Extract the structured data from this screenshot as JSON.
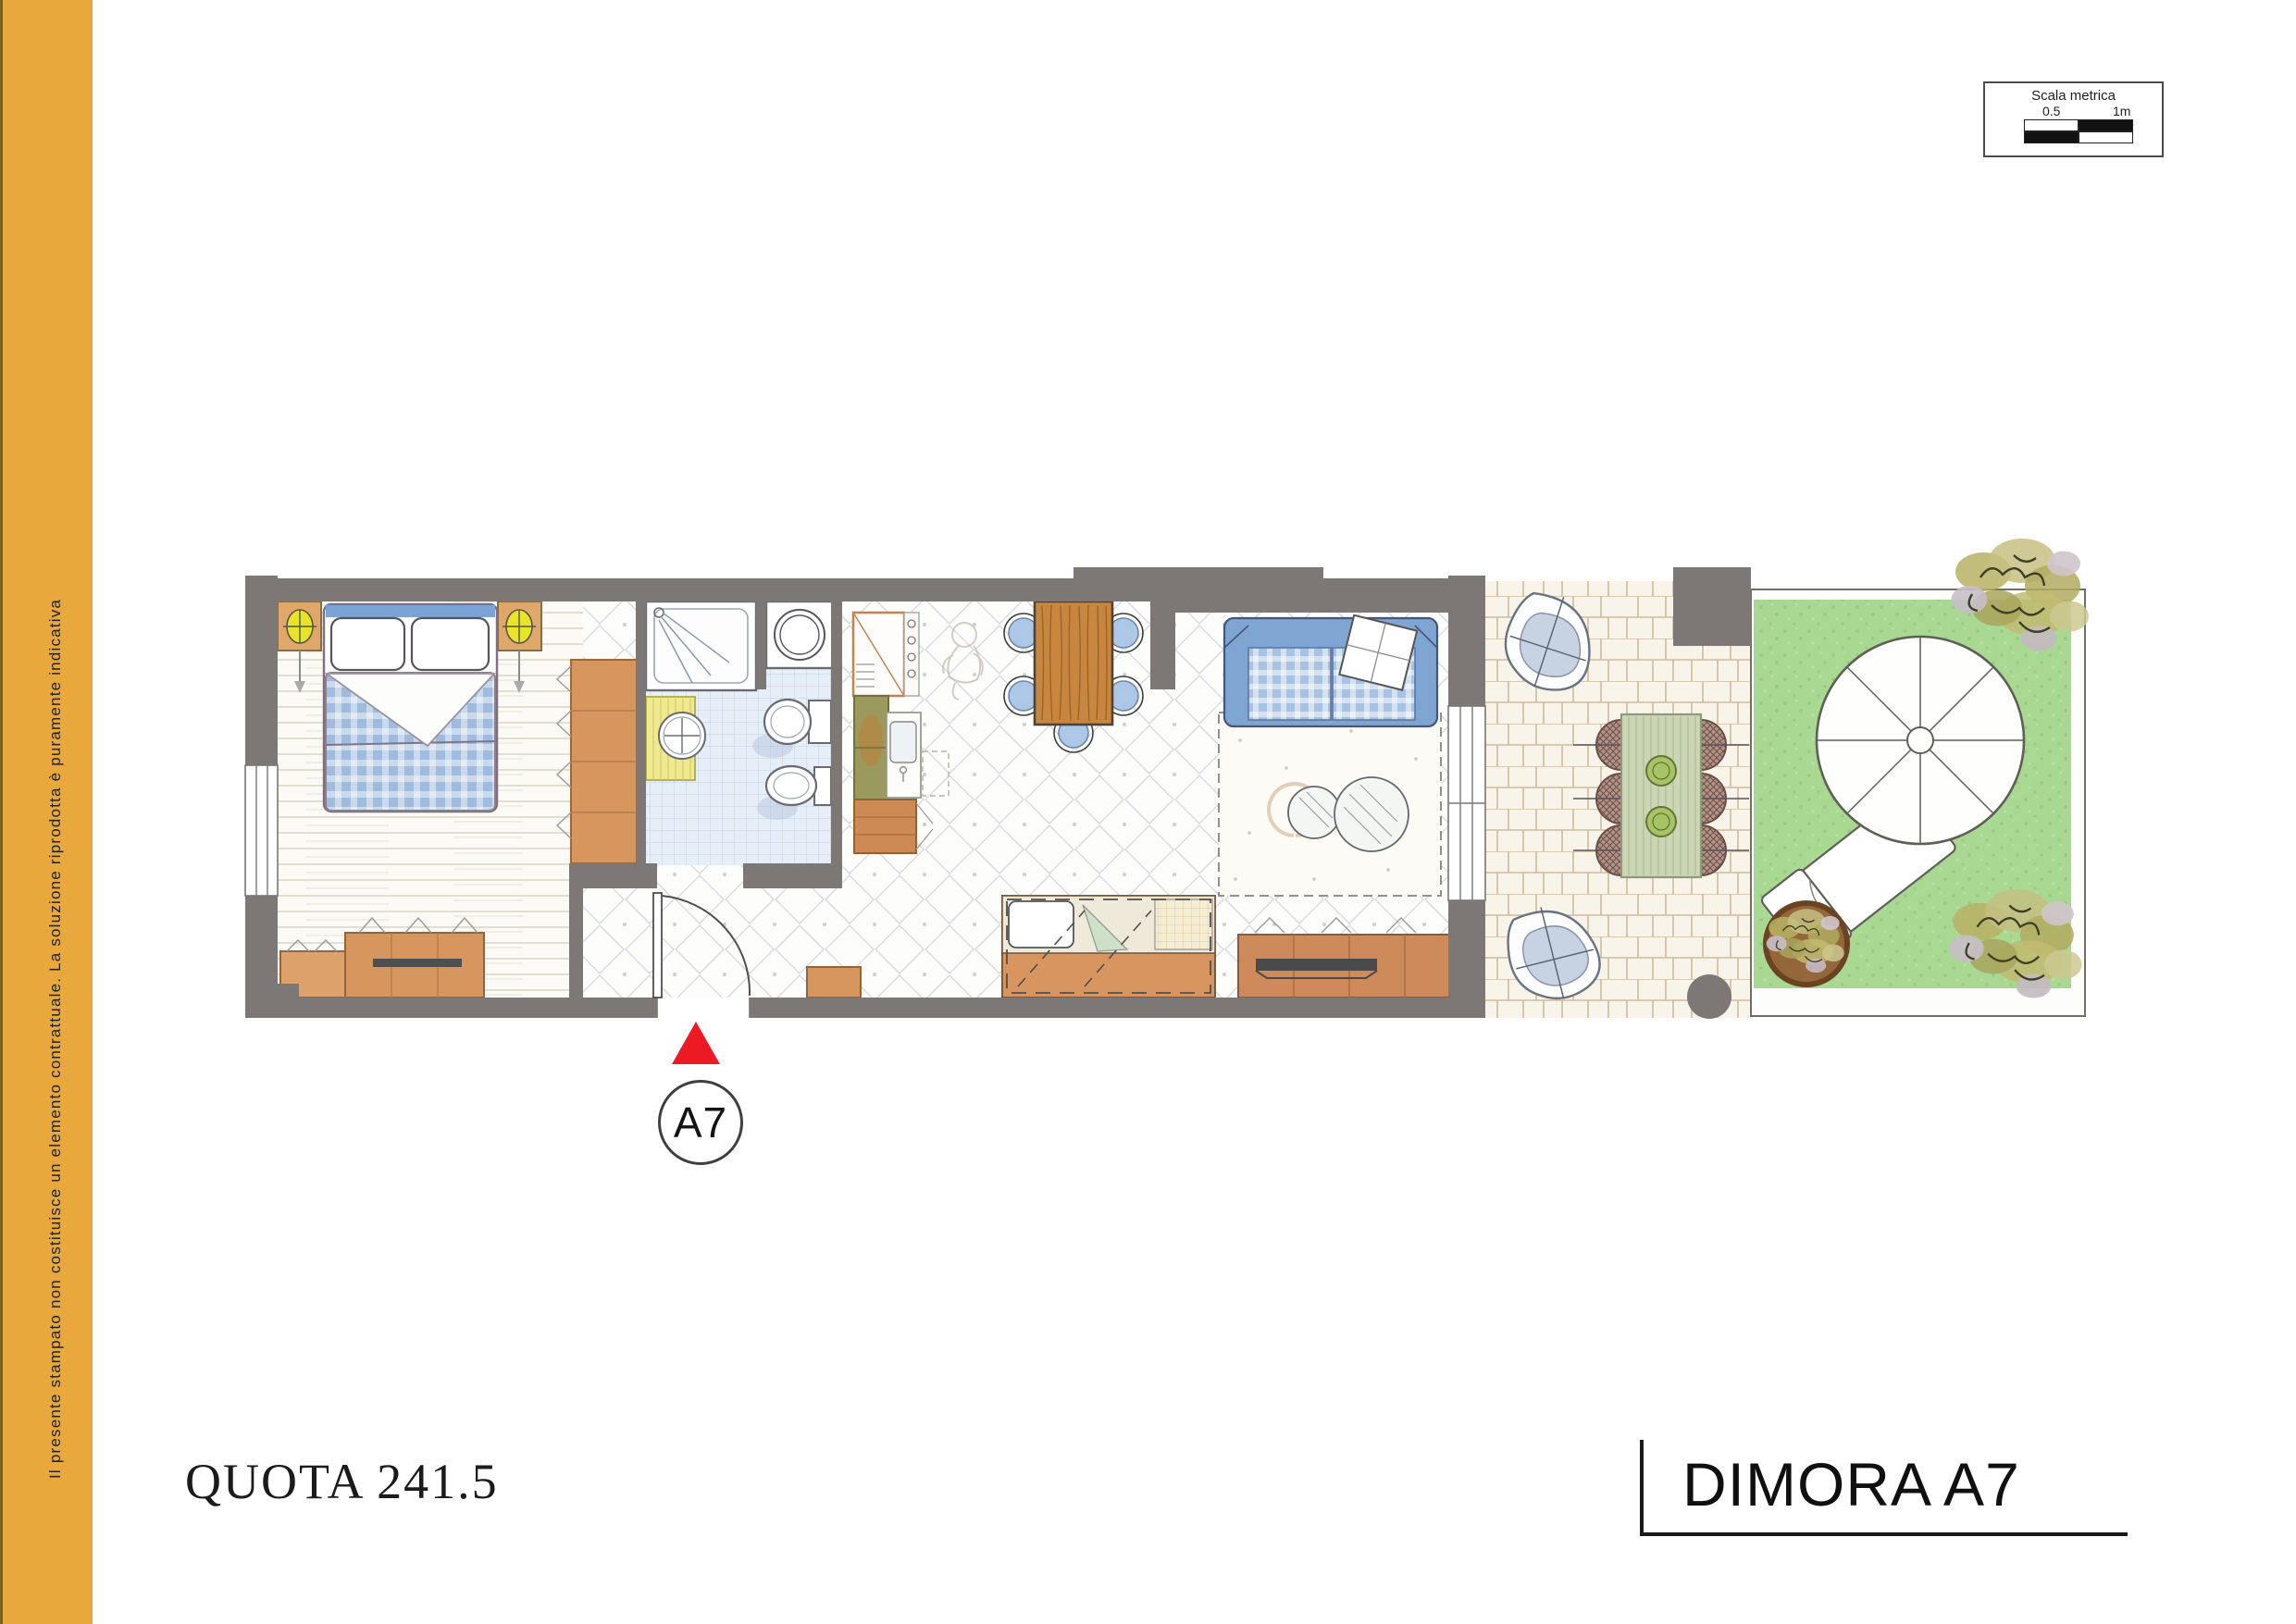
{
  "colors": {
    "sidebar_yellow": "#E8A83B",
    "wall_gray": "#7D7775",
    "marker_red": "#EC1B23",
    "lawn_green": "#A8D892",
    "sofa_blue": "#7FA5D2",
    "wood_orange": "#D8965F",
    "bath_tile_blue": "#E6EEF7",
    "patio_stone": "#F8F4EA"
  },
  "sidebar": {
    "disclaimer": "Il presente stampato non costituisce un elemento contrattuale. La soluzione riprodotta è puramente indicativa"
  },
  "scale_box": {
    "title": "Scala metrica",
    "label_mid": "0.5",
    "label_end": "1m"
  },
  "entrance_marker": {
    "label": "A7"
  },
  "footer": {
    "quota_label": "QUOTA 241.5",
    "plan_title": "DIMORA A7"
  }
}
